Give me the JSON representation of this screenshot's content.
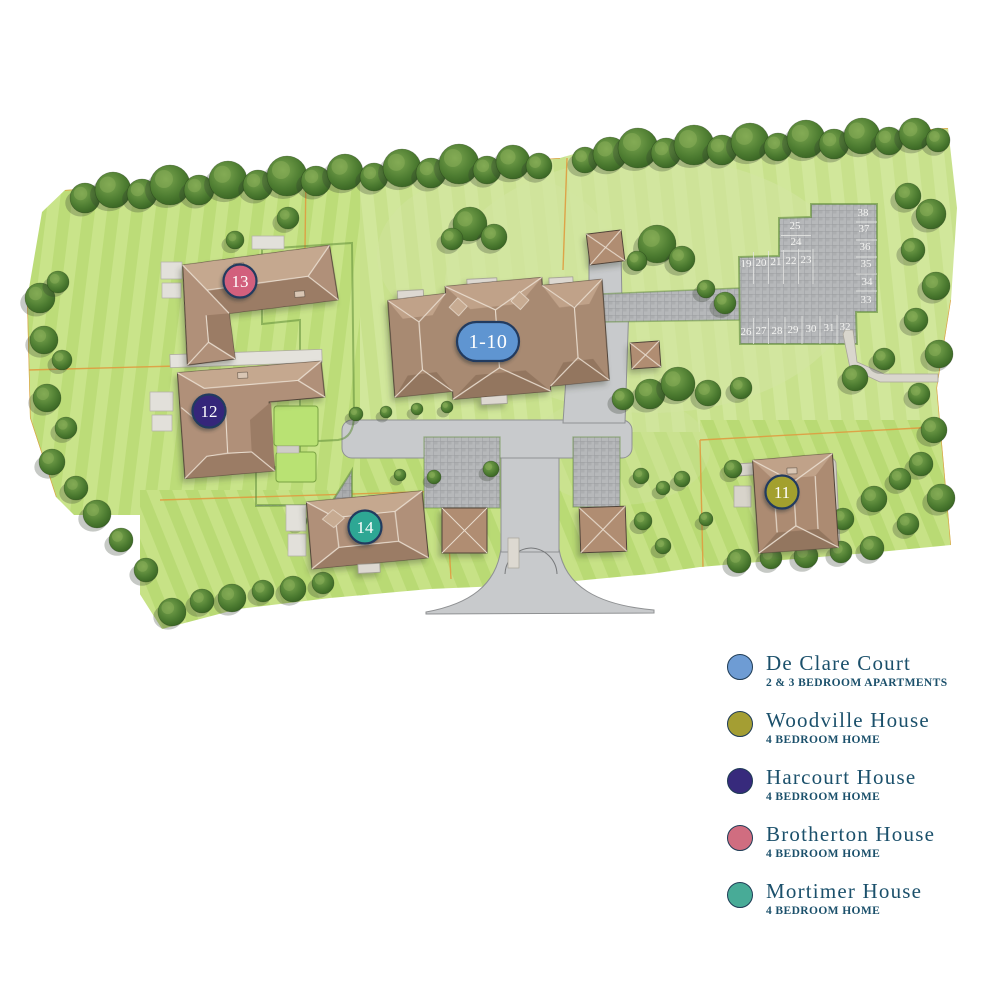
{
  "plan": {
    "marker_ring_color": "#223a5f",
    "markers": [
      {
        "key": "de-clare-court",
        "label": "1-10",
        "color": "#5e95d1"
      },
      {
        "key": "woodville-house",
        "label": "11",
        "color": "#a3a02f"
      },
      {
        "key": "harcourt-house",
        "label": "12",
        "color": "#35287a"
      },
      {
        "key": "brotherton-house",
        "label": "13",
        "color": "#d2607d"
      },
      {
        "key": "mortimer-house",
        "label": "14",
        "color": "#2ea794"
      }
    ],
    "parking_spaces": [
      "19",
      "20",
      "21",
      "22",
      "23",
      "24",
      "25",
      "26",
      "27",
      "28",
      "29",
      "30",
      "31",
      "32",
      "33",
      "34",
      "35",
      "36",
      "37",
      "38"
    ]
  },
  "legend": {
    "text_color": "#1b506b",
    "items": [
      {
        "title": "De Clare Court",
        "subtitle": "2 & 3 BEDROOM APARTMENTS",
        "color": "#6e9cd4"
      },
      {
        "title": "Woodville House",
        "subtitle": "4 BEDROOM HOME",
        "color": "#a49e33"
      },
      {
        "title": "Harcourt House",
        "subtitle": "4 BEDROOM HOME",
        "color": "#372a7c"
      },
      {
        "title": "Brotherton House",
        "subtitle": "4 BEDROOM HOME",
        "color": "#d06d80"
      },
      {
        "title": "Mortimer House",
        "subtitle": "4 BEDROOM HOME",
        "color": "#48ab97"
      }
    ]
  }
}
